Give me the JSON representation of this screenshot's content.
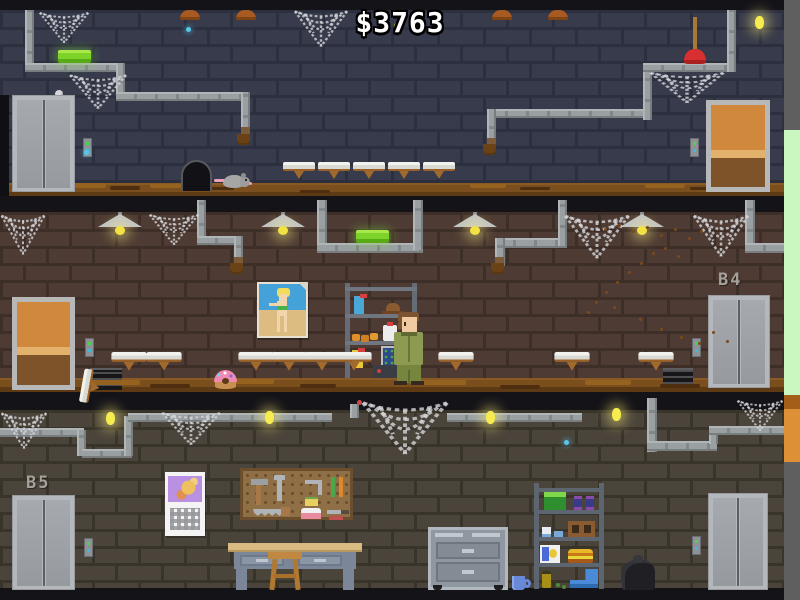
{
  "hud": {
    "money": "$3763"
  },
  "labels": {
    "middle_right": "B4",
    "bottom_left": "B5"
  },
  "palette": {
    "wall_top_brick": "#373b4b",
    "wall_top_mortar": "#2c2f3e",
    "wall_mid_brick": "#4e3c34",
    "wall_mid_mortar": "#3d2e28",
    "wall_bot_brick": "#4a443b",
    "wall_bot_mortar": "#393429",
    "pipe_gray": "#9aa0a2",
    "floor_brown": "#7b4e1e",
    "glow_brick_green": "#7ed32a",
    "firefly_yellow": "#f6ec50",
    "firefly_blue": "#56c8e8",
    "money_text": "#ffffff",
    "strip_green": "#c9f7bf",
    "strip_orange": "#de9036",
    "strip_gray": "#5f5f5f",
    "door_orange": "#d0883c",
    "elevator_gray": "#b4b8bc"
  },
  "sprites": {
    "pipes": [
      [
        25,
        10,
        9,
        62,
        "v"
      ],
      [
        25,
        63,
        100,
        9,
        "h"
      ],
      [
        116,
        63,
        9,
        38,
        "v"
      ],
      [
        116,
        92,
        134,
        9,
        "h"
      ],
      [
        241,
        92,
        9,
        44,
        "v"
      ],
      [
        487,
        109,
        165,
        9,
        "h"
      ],
      [
        487,
        109,
        9,
        38,
        "v"
      ],
      [
        643,
        63,
        9,
        57,
        "v"
      ],
      [
        643,
        63,
        93,
        9,
        "h"
      ],
      [
        727,
        10,
        9,
        62,
        "v"
      ],
      [
        197,
        200,
        9,
        44,
        "v"
      ],
      [
        197,
        236,
        46,
        9,
        "h"
      ],
      [
        234,
        236,
        9,
        30,
        "v"
      ],
      [
        317,
        200,
        10,
        50,
        "v"
      ],
      [
        317,
        243,
        106,
        10,
        "h"
      ],
      [
        413,
        200,
        10,
        50,
        "v"
      ],
      [
        495,
        238,
        72,
        10,
        "h"
      ],
      [
        558,
        200,
        9,
        46,
        "v"
      ],
      [
        495,
        238,
        10,
        28,
        "v"
      ],
      [
        745,
        200,
        10,
        50,
        "v"
      ],
      [
        745,
        243,
        39,
        10,
        "h"
      ],
      [
        0,
        428,
        84,
        9,
        "h"
      ],
      [
        77,
        430,
        9,
        26,
        "v"
      ],
      [
        82,
        449,
        50,
        9,
        "h"
      ],
      [
        124,
        416,
        9,
        40,
        "v"
      ],
      [
        128,
        413,
        204,
        9,
        "h"
      ],
      [
        447,
        413,
        135,
        9,
        "h"
      ],
      [
        350,
        404,
        9,
        14,
        "v"
      ],
      [
        647,
        398,
        10,
        54,
        "v"
      ],
      [
        647,
        441,
        70,
        10,
        "h"
      ],
      [
        709,
        426,
        9,
        18,
        "v"
      ],
      [
        709,
        426,
        75,
        9,
        "h"
      ]
    ],
    "rust": [
      [
        241,
        127,
        9,
        9
      ],
      [
        487,
        138,
        9,
        9
      ],
      [
        234,
        257,
        9,
        9
      ],
      [
        495,
        257,
        9,
        9
      ]
    ],
    "leaks": [
      [
        237,
        134
      ],
      [
        483,
        144
      ],
      [
        230,
        263
      ],
      [
        491,
        263
      ]
    ],
    "toilets_top": {
      "y": 162,
      "xs": [
        283,
        318,
        353,
        388,
        423
      ]
    },
    "toilets_middle": {
      "y": 355,
      "xs": [
        113,
        148,
        240,
        273,
        306,
        338,
        440,
        556,
        640
      ]
    },
    "tipped_toilet": {
      "x": 88,
      "y": 362
    },
    "dome_lamps": {
      "y": 10,
      "xs": [
        180,
        236,
        492,
        548
      ]
    },
    "hanging_lamps": {
      "y": 212,
      "xs": [
        98,
        261,
        453,
        620
      ]
    },
    "cobwebs": [
      [
        38,
        10,
        52,
        34
      ],
      [
        68,
        72,
        60,
        38
      ],
      [
        293,
        8,
        56,
        40
      ],
      [
        648,
        70,
        78,
        34
      ],
      [
        0,
        212,
        46,
        44
      ],
      [
        148,
        212,
        52,
        34
      ],
      [
        563,
        212,
        68,
        48
      ],
      [
        692,
        212,
        58,
        46
      ],
      [
        0,
        410,
        48,
        40
      ],
      [
        160,
        410,
        62,
        36
      ],
      [
        360,
        398,
        90,
        58
      ],
      [
        736,
        398,
        48,
        34
      ]
    ],
    "fireflies": [
      {
        "x": 394,
        "y": 23,
        "c": "g",
        "glow": false
      },
      {
        "x": 755,
        "y": 16,
        "c": "y",
        "glow": true
      },
      {
        "x": 186,
        "y": 27,
        "c": "b",
        "glow": false
      },
      {
        "x": 84,
        "y": 150,
        "c": "b",
        "glow": false
      },
      {
        "x": 357,
        "y": 400,
        "c": "r",
        "glow": false
      },
      {
        "x": 106,
        "y": 412,
        "c": "y",
        "glow": true
      },
      {
        "x": 265,
        "y": 411,
        "c": "y",
        "glow": true
      },
      {
        "x": 486,
        "y": 411,
        "c": "y",
        "glow": true
      },
      {
        "x": 612,
        "y": 408,
        "c": "y",
        "glow": true
      },
      {
        "x": 564,
        "y": 440,
        "c": "b",
        "glow": false
      }
    ],
    "flies": [
      [
        604,
        228
      ],
      [
        618,
        224
      ],
      [
        632,
        230
      ],
      [
        646,
        226
      ],
      [
        660,
        234
      ],
      [
        674,
        228
      ],
      [
        688,
        237
      ],
      [
        700,
        230
      ],
      [
        664,
        247
      ],
      [
        677,
        255
      ],
      [
        652,
        252
      ],
      [
        640,
        262
      ],
      [
        628,
        271
      ],
      [
        616,
        281
      ],
      [
        605,
        291
      ],
      [
        595,
        301
      ],
      [
        587,
        311
      ],
      [
        613,
        306
      ],
      [
        639,
        318
      ],
      [
        660,
        328
      ],
      [
        680,
        336
      ],
      [
        698,
        342
      ],
      [
        712,
        331
      ],
      [
        726,
        340
      ]
    ],
    "dirt": [
      [
        60,
        183,
        46,
        5,
        "#96621f"
      ],
      [
        110,
        186,
        30,
        4,
        "#4e2e0e"
      ],
      [
        150,
        184,
        46,
        4,
        "#96621f"
      ],
      [
        210,
        187,
        24,
        3,
        "#4e2e0e"
      ],
      [
        300,
        190,
        30,
        3,
        "#4e2e0e"
      ],
      [
        470,
        184,
        36,
        4,
        "#96621f"
      ],
      [
        520,
        187,
        30,
        3,
        "#4e2e0e"
      ],
      [
        645,
        184,
        40,
        4,
        "#96621f"
      ],
      [
        690,
        187,
        26,
        3,
        "#4e2e0e"
      ],
      [
        90,
        380,
        50,
        5,
        "#96621f"
      ],
      [
        150,
        384,
        40,
        4,
        "#4e2e0e"
      ],
      [
        230,
        379,
        44,
        5,
        "#96621f"
      ],
      [
        300,
        384,
        36,
        4,
        "#4e2e0e"
      ],
      [
        410,
        380,
        56,
        5,
        "#96621f"
      ],
      [
        500,
        385,
        40,
        4,
        "#4e2e0e"
      ],
      [
        585,
        380,
        46,
        5,
        "#96621f"
      ],
      [
        660,
        384,
        40,
        4,
        "#4e2e0e"
      ]
    ]
  }
}
